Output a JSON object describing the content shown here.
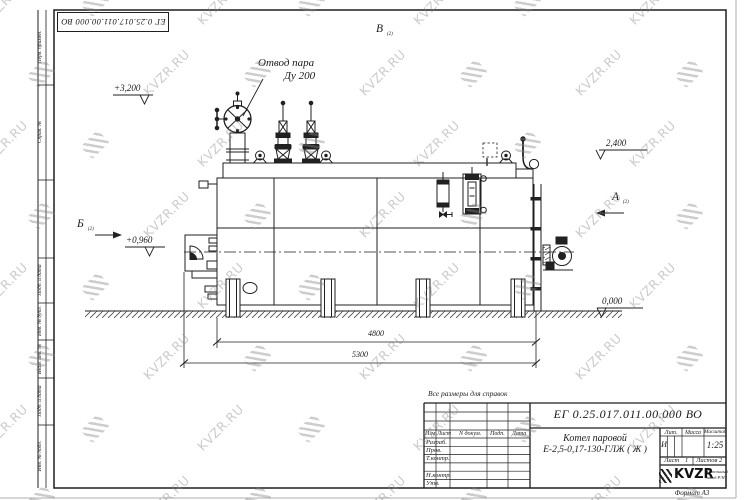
{
  "watermark": {
    "text": "KVZR.RU"
  },
  "top_stamp": {
    "doc_number": "ЕГ 0.25.017.011.00.000  ВО"
  },
  "margin": {
    "perv_primen": "Перв. примен.",
    "sprav_no": "Справ. №",
    "podp_data_1": "Подп. и дата",
    "inv_dubl": "Инв. № дубл.",
    "vzam_inv": "Взам. инв. №",
    "podp_data_2": "Подп. и дата",
    "inv_podl": "Инв. № подл."
  },
  "drawing": {
    "steam_label_1": "Отвод пара",
    "steam_label_2": "Ду 200",
    "view_v": "В",
    "view_v_sub": "(2)",
    "view_a": "А",
    "view_a_sub": "(2)",
    "view_b": "Б",
    "view_b_sub": "(2)",
    "elev_top": "+3,200",
    "elev_rear": "2,400",
    "elev_burner": "+0,960",
    "elev_zero": "0,000",
    "dim_inner": "4800",
    "dim_overall": "5300"
  },
  "note": "Все размеры для справок",
  "title_block": {
    "doc_number": "ЕГ 0.25.017.011.00.000  ВО",
    "name_line1": "Котел паровой",
    "name_line2": "Е-2,5-0,17-130-ГЛЖ ( Ж )",
    "columns": {
      "izm": "Изм",
      "list": "Лист",
      "n_dokum": "N докум.",
      "podp": "Подп.",
      "data": "Дата"
    },
    "rows": [
      "Разраб.",
      "Пров.",
      "Т.контр.",
      "",
      "Н.контр.",
      "Утв."
    ],
    "lit_label": "Лит.",
    "mass_label": "Масса",
    "scale_label": "Масштаб",
    "lit_value": "И",
    "scale_value": "1:25",
    "sheet_label": "Лист",
    "sheet_value": "1",
    "sheets_label": "Листов",
    "sheets_value": "2",
    "logo": "KVZR",
    "logo_sub1": "Котельный",
    "logo_sub2": "завод РЭП",
    "format_text": "Формат  А3"
  }
}
